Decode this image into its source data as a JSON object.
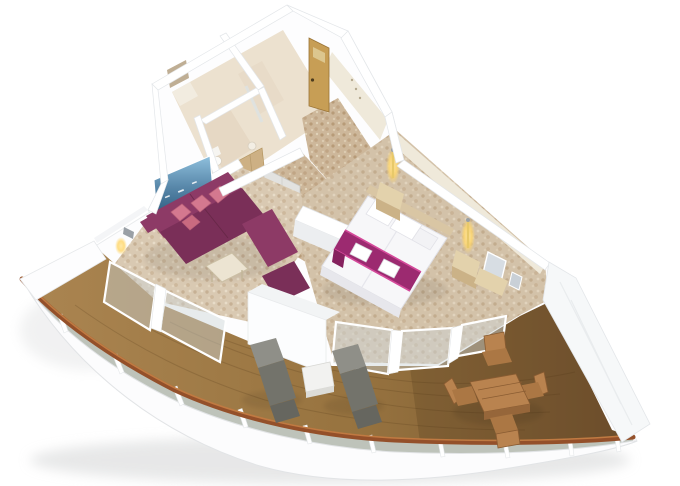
{
  "meta": {
    "title": "3D isometric rendering of a cruise-ship suite floor plan with bathroom, entry corridor, living area, bedroom and a large curved private balcony"
  },
  "palette": {
    "background": "#ffffff",
    "wall_white": "#fdfdfe",
    "wall_shade": "#eceef0",
    "tile_wall": "#ece1cf",
    "tile_floor": "#e6d8c4",
    "entry_door": "#c79e55",
    "wardrobe_wood": "#cdb084",
    "interior_door_gray": "#e2e2e0",
    "sofa_plum": "#8d3a66",
    "sofa_plum_dark": "#7a2f58",
    "pillow_pink": "#d4788f",
    "bed_white": "#f7f7f9",
    "runner_magenta": "#9c2a70",
    "runner_trim": "#d44a9a",
    "headboard_wood": "#d9c6a4",
    "nightstand_wood": "#e3d2ac",
    "vanity_mirror": "#d7dde3",
    "lamp_glow": "#ffd76e",
    "deck_wood_light": "#a8824f",
    "deck_wood_dark": "#755431",
    "cap_rail_brown": "#94502a",
    "railing_glass": "#b7bcb2",
    "lounger_gray": "#8f8f88",
    "lounger_gray_dark": "#73736b",
    "outdoor_wood": "#b9834f",
    "outdoor_wood_dark": "#96663a",
    "artwork_sky": "#8fc0dd",
    "artwork_sea": "#2c5b7f",
    "carpet_base": "#d9c9b2",
    "corridor_carpet": "#cdb79a"
  },
  "scene": {
    "rooms": [
      {
        "name": "bathroom"
      },
      {
        "name": "shower-room"
      },
      {
        "name": "entry-corridor"
      },
      {
        "name": "living-area"
      },
      {
        "name": "bedroom"
      },
      {
        "name": "private-balcony"
      }
    ],
    "furniture": [
      "entry-door",
      "wardrobe",
      "sectional-sofa",
      "pink-accent-pillows",
      "coffee-table",
      "seascape-wall-art",
      "double-bed",
      "magenta-bed-runner",
      "folded-towels",
      "nightstands",
      "wall-lamps",
      "vanity-with-mirror",
      "sun-loungers",
      "balcony-side-table",
      "outdoor-dining-table",
      "outdoor-dining-chairs"
    ]
  }
}
